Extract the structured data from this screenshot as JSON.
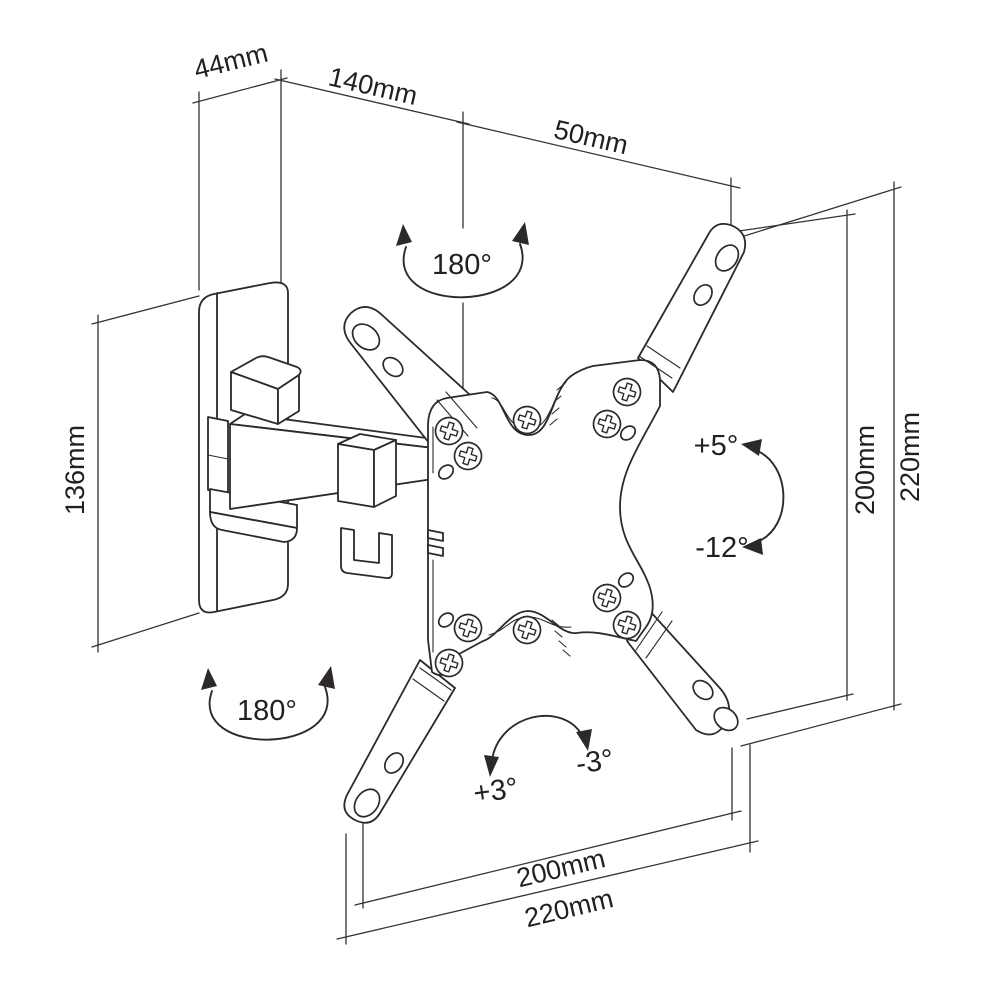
{
  "colors": {
    "background": "#ffffff",
    "line": "#2d292a",
    "text": "#231f20"
  },
  "dimensions": {
    "depth": "44mm",
    "arm_length": "140mm",
    "arm_extension": "50mm",
    "wall_plate_height": "136mm",
    "vesa_height": "200mm",
    "plate_height": "220mm",
    "vesa_width": "200mm",
    "plate_width": "220mm"
  },
  "rotations": {
    "swivel_top": "180°",
    "swivel_bottom": "180°",
    "tilt_up": "+5°",
    "tilt_down": "-12°",
    "roll_left": "+3°",
    "roll_right": "-3°"
  }
}
